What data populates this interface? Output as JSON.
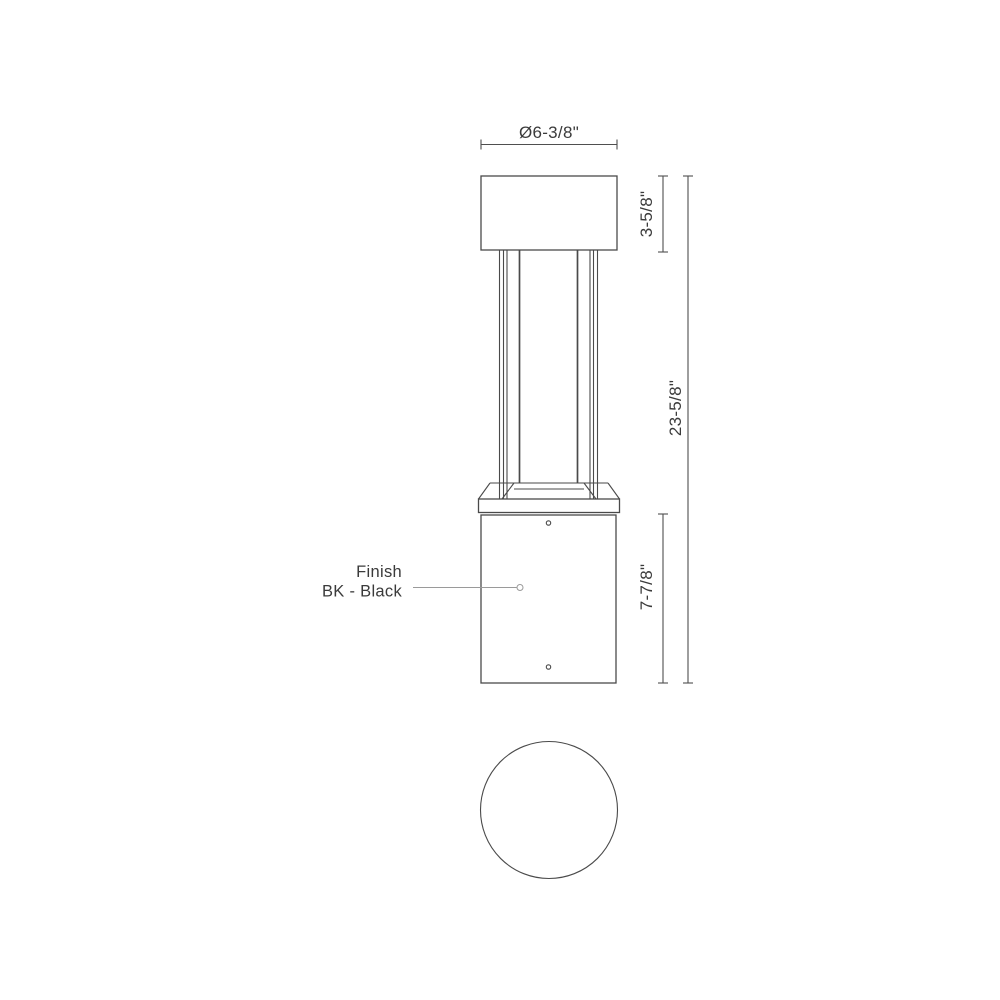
{
  "drawing": {
    "dim_diameter": "Ø6-3/8\"",
    "dim_top_section": "3-5/8\"",
    "dim_overall": "23-5/8\"",
    "dim_base_section": "7-7/8\"",
    "finish_line1": "Finish",
    "finish_line2": "BK - Black",
    "colors": {
      "line": "#4a4a4a",
      "dimension": "#4f4f4f",
      "leader": "#9a9a9a",
      "text": "#3b3b3b",
      "background": "#ffffff"
    }
  }
}
